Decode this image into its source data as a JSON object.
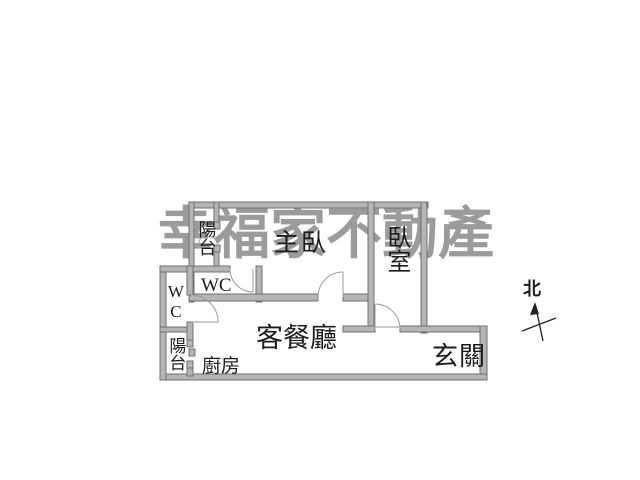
{
  "watermark": {
    "text": "幸福家不動產"
  },
  "compass": {
    "north_label": "北"
  },
  "rooms": {
    "balcony_top": {
      "label": "陽台"
    },
    "master_bedroom": {
      "label": "主臥"
    },
    "bedroom": {
      "label": "臥室"
    },
    "master_wc": {
      "label": "WC"
    },
    "side_wc": {
      "label": "WC"
    },
    "living_dining": {
      "label": "客餐廳"
    },
    "entry": {
      "label": "玄關"
    },
    "kitchen": {
      "label": "廚房"
    },
    "balcony_bottom": {
      "label": "陽台"
    }
  },
  "colors": {
    "background": "#ffffff",
    "wall_fill": "#b5b5b5",
    "wall_edge": "#6f6f6f",
    "door_line": "#9a9a9a",
    "label_text": "#1c1c1c",
    "watermark": "#9b9b9b",
    "compass": "#222222"
  }
}
